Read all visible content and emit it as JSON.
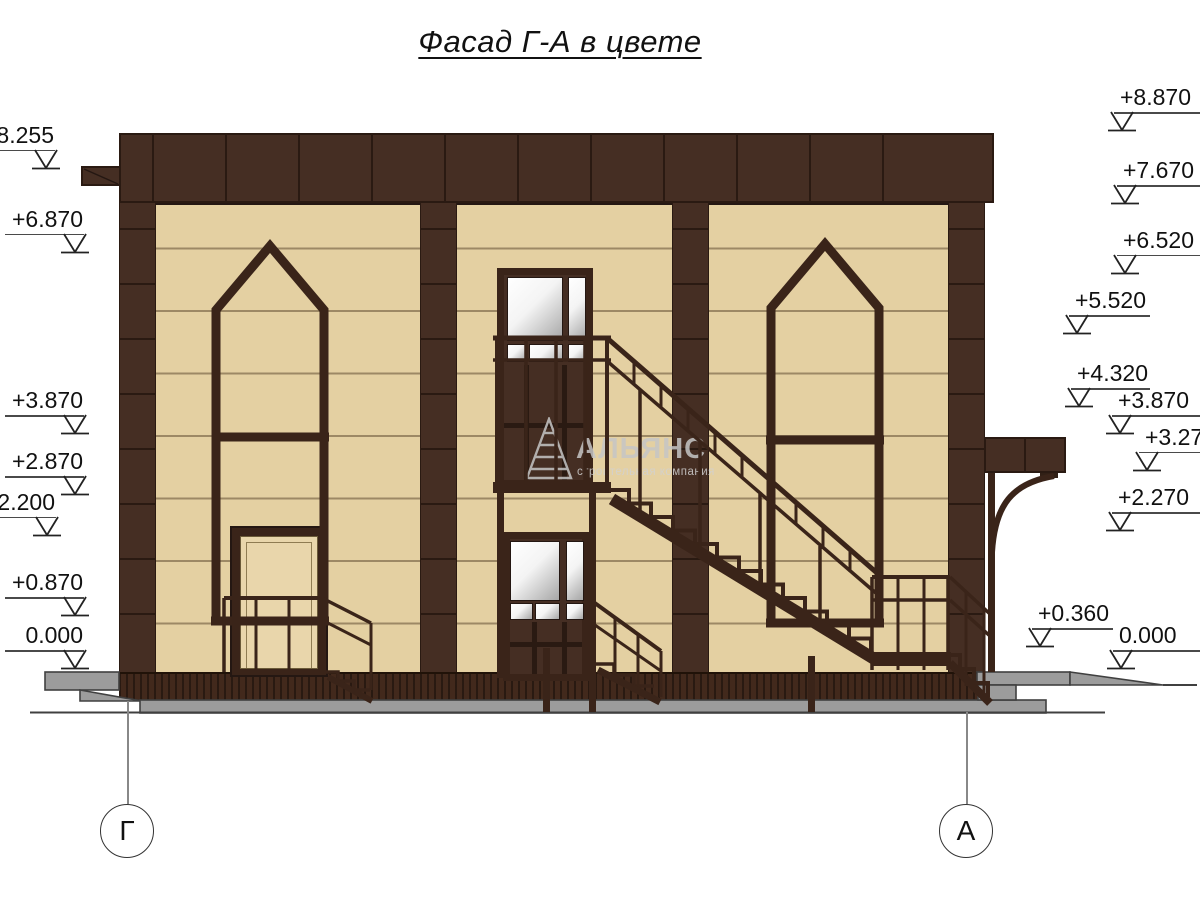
{
  "title": "Фасад Г-А в цвете",
  "drawing": {
    "watermark": {
      "name": "АЛЬЯНС",
      "subtitle": "строительная компания"
    },
    "axis_markers": [
      {
        "label": "Г"
      },
      {
        "label": "А"
      }
    ],
    "elevation_marks_left": [
      {
        "label": "+8.255",
        "value": 8.255
      },
      {
        "label": "+6.870",
        "value": 6.87
      },
      {
        "label": "+3.870",
        "value": 3.87
      },
      {
        "label": "+2.870",
        "value": 2.87
      },
      {
        "label": "+2.200",
        "value": 2.2
      },
      {
        "label": "+0.870",
        "value": 0.87
      },
      {
        "label": "0.000",
        "value": 0.0
      }
    ],
    "elevation_marks_right": [
      {
        "label": "+8.870",
        "value": 8.87
      },
      {
        "label": "+7.670",
        "value": 7.67
      },
      {
        "label": "+6.520",
        "value": 6.52
      },
      {
        "label": "+5.520",
        "value": 5.52
      },
      {
        "label": "+4.320",
        "value": 4.32
      },
      {
        "label": "+3.870",
        "value": 3.87
      },
      {
        "label": "+3.270",
        "value": 3.27
      },
      {
        "label": "+2.270",
        "value": 2.27
      },
      {
        "label": "+0.360",
        "value": 0.36
      },
      {
        "label": "0.000",
        "value": 0.0
      }
    ],
    "colors": {
      "facade_brown": "#452e23",
      "seam_dark": "#2a1a12",
      "wall_cream": "#e4d0a2",
      "glass_white": "#ffffff",
      "pavement_gray": "#9c9c9c",
      "watermark_gray": "#c6c6c6"
    }
  }
}
